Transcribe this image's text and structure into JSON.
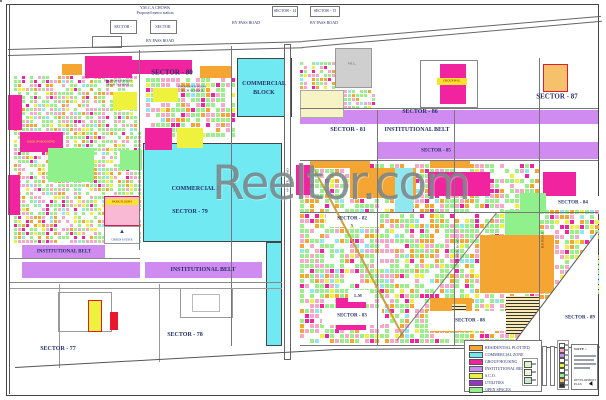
{
  "watermark": {
    "text": "Reeltor.com"
  },
  "map": {
    "mosaic_palette": {
      "cuts": [
        0.3,
        0.48,
        0.58,
        0.64,
        0.7,
        0.74
      ],
      "colors": [
        "#9BEE8C",
        "#F7A8C9",
        "#F5A531",
        "#F2239E",
        "#EEF23D",
        "#8FE8F0"
      ]
    },
    "mosaics": [
      {
        "x": 14,
        "y": 76,
        "w": 124,
        "h": 54,
        "cell": 4,
        "seed": 7
      },
      {
        "x": 14,
        "y": 132,
        "w": 126,
        "h": 112,
        "cell": 4,
        "seed": 13
      },
      {
        "x": 146,
        "y": 78,
        "w": 86,
        "h": 60,
        "cell": 5,
        "seed": 21
      },
      {
        "x": 300,
        "y": 164,
        "w": 238,
        "h": 178,
        "cell": 5,
        "seed": 29
      },
      {
        "x": 300,
        "y": 62,
        "w": 34,
        "h": 56,
        "cell": 4,
        "seed": 41
      },
      {
        "x": 336,
        "y": 90,
        "w": 40,
        "h": 28,
        "cell": 4,
        "seed": 55
      },
      {
        "x": 540,
        "y": 210,
        "w": 58,
        "h": 90,
        "cell": 5,
        "seed": 77
      }
    ],
    "areas": [
      {
        "x": 237,
        "y": 58,
        "w": 55,
        "h": 59,
        "c": "#70E9F2",
        "bd": "#444"
      },
      {
        "x": 143,
        "y": 143,
        "w": 139,
        "h": 99,
        "c": "#70E9F2",
        "bd": "#444"
      },
      {
        "x": 266,
        "y": 242,
        "w": 16,
        "h": 104,
        "c": "#70E9F2",
        "bd": "#444"
      },
      {
        "x": 300,
        "y": 110,
        "w": 298,
        "h": 14,
        "c": "#CF8BEF"
      },
      {
        "x": 378,
        "y": 142,
        "w": 220,
        "h": 17,
        "c": "#CF8BEF"
      },
      {
        "x": 22,
        "y": 245,
        "w": 83,
        "h": 13,
        "c": "#CF8BEF"
      },
      {
        "x": 22,
        "y": 262,
        "w": 118,
        "h": 16,
        "c": "#CF8BEF"
      },
      {
        "x": 145,
        "y": 262,
        "w": 117,
        "h": 16,
        "c": "#CF8BEF"
      },
      {
        "x": 85,
        "y": 56,
        "w": 47,
        "h": 22,
        "c": "#F2239E"
      },
      {
        "x": 132,
        "y": 60,
        "w": 60,
        "h": 14,
        "c": "#F2239E"
      },
      {
        "x": 200,
        "y": 66,
        "w": 32,
        "h": 12,
        "c": "#F5A531"
      },
      {
        "x": 62,
        "y": 64,
        "w": 20,
        "h": 11,
        "c": "#F5A531"
      },
      {
        "x": 113,
        "y": 92,
        "w": 24,
        "h": 18,
        "c": "#EEF23D"
      },
      {
        "x": 153,
        "y": 88,
        "w": 25,
        "h": 14,
        "c": "#EEF23D"
      },
      {
        "x": 145,
        "y": 128,
        "w": 27,
        "h": 22,
        "c": "#F2239E"
      },
      {
        "x": 177,
        "y": 128,
        "w": 26,
        "h": 20,
        "c": "#EEF23D"
      },
      {
        "x": 8,
        "y": 95,
        "w": 14,
        "h": 35,
        "c": "#F2239E"
      },
      {
        "x": 20,
        "y": 132,
        "w": 43,
        "h": 20,
        "c": "#F2239E"
      },
      {
        "x": 8,
        "y": 175,
        "w": 12,
        "h": 40,
        "c": "#F2239E"
      },
      {
        "x": 48,
        "y": 148,
        "w": 46,
        "h": 34,
        "c": "#90F08B"
      },
      {
        "x": 120,
        "y": 150,
        "w": 22,
        "h": 20,
        "c": "#90F08B"
      },
      {
        "x": 335,
        "y": 48,
        "w": 37,
        "h": 40,
        "c": "#CFCFCF",
        "bd": "#999"
      },
      {
        "x": 300,
        "y": 90,
        "w": 44,
        "h": 28,
        "c": "#F7F3C4",
        "bd": "#aaa"
      },
      {
        "x": 543,
        "y": 64,
        "w": 25,
        "h": 28,
        "c": "#F5C26B",
        "bd": "#E8192C"
      },
      {
        "x": 350,
        "y": 168,
        "w": 66,
        "h": 30,
        "c": "#F5A531"
      },
      {
        "x": 428,
        "y": 172,
        "w": 62,
        "h": 24,
        "c": "#F2239E"
      },
      {
        "x": 543,
        "y": 172,
        "w": 33,
        "h": 24,
        "c": "#F2239E"
      },
      {
        "x": 395,
        "y": 168,
        "w": 18,
        "h": 44,
        "c": "#8FE8F0"
      },
      {
        "x": 296,
        "y": 165,
        "w": 14,
        "h": 30,
        "c": "#F2239E"
      },
      {
        "x": 505,
        "y": 210,
        "w": 34,
        "h": 36,
        "c": "#90F08B"
      },
      {
        "x": 520,
        "y": 193,
        "w": 26,
        "h": 20,
        "c": "#90F08B"
      },
      {
        "x": 480,
        "y": 235,
        "w": 74,
        "h": 58,
        "c": "#F5A531"
      },
      {
        "x": 430,
        "y": 298,
        "w": 42,
        "h": 34,
        "c": "#F5A531"
      },
      {
        "x": 556,
        "y": 286,
        "w": 32,
        "h": 34,
        "c": "#F2239E"
      },
      {
        "x": 336,
        "y": 298,
        "w": 30,
        "h": 32,
        "c": "#F2239E"
      },
      {
        "x": 506,
        "y": 296,
        "w": 34,
        "h": 38,
        "stripe": true
      },
      {
        "x": 452,
        "y": 304,
        "w": 14,
        "h": 18,
        "stripe": true
      },
      {
        "x": 310,
        "y": 160,
        "w": 60,
        "h": 8,
        "c": "#F5A531"
      },
      {
        "x": 430,
        "y": 160,
        "w": 40,
        "h": 8,
        "c": "#F5A531"
      },
      {
        "x": 512,
        "y": 230,
        "w": 86,
        "h": 115,
        "c": "#fff",
        "clip": "polygon(100% 0, 100% 100%, 0 100%)"
      },
      {
        "x": 326,
        "y": 212,
        "w": 54,
        "h": 15,
        "c": "#fff"
      },
      {
        "x": 548,
        "y": 196,
        "w": 52,
        "h": 14,
        "c": "#fff"
      },
      {
        "x": 348,
        "y": 290,
        "w": 22,
        "h": 12,
        "c": "#fff"
      },
      {
        "x": 322,
        "y": 308,
        "w": 60,
        "h": 17,
        "c": "#fff"
      },
      {
        "x": 428,
        "y": 311,
        "w": 78,
        "h": 20,
        "c": "#fff"
      },
      {
        "x": 110,
        "y": 20,
        "w": 27,
        "h": 14,
        "c": "#fff",
        "bd": "#777"
      },
      {
        "x": 150,
        "y": 20,
        "w": 27,
        "h": 14,
        "c": "#fff",
        "bd": "#777"
      },
      {
        "x": 92,
        "y": 36,
        "w": 30,
        "h": 12,
        "c": "#fff",
        "bd": "#777"
      },
      {
        "x": 272,
        "y": 6,
        "w": 26,
        "h": 11,
        "c": "#fff",
        "bd": "#777"
      },
      {
        "x": 310,
        "y": 6,
        "w": 30,
        "h": 11,
        "c": "#fff",
        "bd": "#777"
      },
      {
        "x": 420,
        "y": 60,
        "w": 58,
        "h": 48,
        "c": "#fff",
        "bd": "#888"
      },
      {
        "x": 440,
        "y": 64,
        "w": 26,
        "h": 40,
        "c": "#F2239E"
      },
      {
        "x": 437,
        "y": 78,
        "w": 30,
        "h": 7,
        "c": "#F7E32B"
      },
      {
        "x": 58,
        "y": 292,
        "w": 54,
        "h": 40,
        "c": "#fff",
        "bd": "#999"
      },
      {
        "x": 180,
        "y": 288,
        "w": 53,
        "h": 30,
        "c": "#fff",
        "bd": "#999"
      },
      {
        "x": 192,
        "y": 294,
        "w": 28,
        "h": 18,
        "c": "#fff",
        "bd": "#bbb"
      },
      {
        "x": 88,
        "y": 300,
        "w": 14,
        "h": 32,
        "c": "#EEF23D",
        "bd": "#E8192C"
      },
      {
        "x": 110,
        "y": 312,
        "w": 8,
        "h": 18,
        "c": "#E8192C"
      },
      {
        "x": 104,
        "y": 196,
        "w": 36,
        "h": 30,
        "c": "#F9B8D4",
        "bd": "#cc2255"
      },
      {
        "x": 106,
        "y": 199,
        "w": 32,
        "h": 6,
        "c": "#F7E32B"
      },
      {
        "x": 104,
        "y": 226,
        "w": 36,
        "h": 18,
        "c": "#fff",
        "bd": "#999"
      },
      {
        "x": 284,
        "y": 44,
        "w": 7,
        "h": 316,
        "c": "#fff",
        "bd": "#666"
      }
    ],
    "roads": [
      {
        "x": 8,
        "y": 49,
        "l": 294,
        "a": -1.5
      },
      {
        "x": 302,
        "y": 41,
        "l": 300,
        "a": -4.8
      },
      {
        "x": 8,
        "y": 55,
        "l": 295,
        "a": -1.5
      },
      {
        "x": 302,
        "y": 47,
        "l": 301,
        "a": -5.0
      },
      {
        "x": 10,
        "y": 4,
        "l": 390,
        "a": 90,
        "c": "#555"
      },
      {
        "x": 140,
        "y": 50,
        "l": 200,
        "a": 90,
        "c": "#777"
      },
      {
        "x": 232,
        "y": 46,
        "l": 300,
        "a": 90,
        "c": "#777"
      },
      {
        "x": 378,
        "y": 110,
        "l": 236,
        "a": 90,
        "c": "#777"
      },
      {
        "x": 455,
        "y": 110,
        "l": 236,
        "a": 90,
        "c": "#777"
      },
      {
        "x": 540,
        "y": 58,
        "l": 288,
        "a": 90,
        "c": "#777"
      },
      {
        "x": 300,
        "y": 108,
        "l": 298,
        "a": 0,
        "c": "#777"
      },
      {
        "x": 300,
        "y": 160,
        "l": 298,
        "a": 0,
        "c": "#777"
      },
      {
        "x": 300,
        "y": 212,
        "l": 298,
        "a": 0,
        "c": "#777"
      },
      {
        "x": 300,
        "y": 345,
        "l": 215,
        "a": 0,
        "c": "#777"
      },
      {
        "x": 10,
        "y": 258,
        "l": 130,
        "a": 0,
        "c": "#888"
      },
      {
        "x": 10,
        "y": 282,
        "l": 272,
        "a": 0,
        "c": "#888"
      },
      {
        "x": 10,
        "y": 288,
        "l": 272,
        "a": 0,
        "c": "#999"
      },
      {
        "x": 60,
        "y": 284,
        "l": 84,
        "a": 90,
        "c": "#999"
      },
      {
        "x": 160,
        "y": 284,
        "l": 78,
        "a": 90,
        "c": "#999"
      },
      {
        "x": 15,
        "y": 367,
        "l": 320,
        "a": -3.2,
        "c": "#555"
      },
      {
        "x": 334,
        "y": 349,
        "l": 266,
        "a": -0.5,
        "c": "#555"
      },
      {
        "x": 312,
        "y": 163,
        "l": 196,
        "a": 62,
        "t": 2,
        "c": "#C9A23F"
      },
      {
        "x": 497,
        "y": 213,
        "l": 162,
        "a": 128,
        "c": "#777"
      },
      {
        "x": 598,
        "y": 232,
        "l": 142,
        "a": 127,
        "c": "#555"
      }
    ],
    "labels": [
      {
        "t": "Y.M.C.A CHOWK",
        "x": 155,
        "y": 8,
        "s": 4
      },
      {
        "t": "Proposed metro station",
        "x": 155,
        "y": 13,
        "s": 4
      },
      {
        "t": "SECTOR -",
        "x": 123,
        "y": 27,
        "s": 4
      },
      {
        "t": "SECTOR",
        "x": 163,
        "y": 27,
        "s": 4
      },
      {
        "t": "BY PASS ROAD",
        "x": 246,
        "y": 23,
        "s": 4
      },
      {
        "t": "BY PASS ROAD",
        "x": 160,
        "y": 41,
        "s": 4
      },
      {
        "t": "SECTOR - 14",
        "x": 285,
        "y": 11,
        "s": 4
      },
      {
        "t": "SECTOR - 15",
        "x": 325,
        "y": 11,
        "s": 4
      },
      {
        "t": "BY PASS ROAD",
        "x": 324,
        "y": 23,
        "s": 4
      },
      {
        "t": "SECTOR - 80",
        "x": 172,
        "y": 73,
        "s": 7,
        "b": 1
      },
      {
        "t": "PROPOSED HIGH",
        "x": 118,
        "y": 81,
        "s": 3.5
      },
      {
        "t": "TECH SCHOOL",
        "x": 118,
        "y": 85,
        "s": 3.5
      },
      {
        "t": "PROPOSED HIGH",
        "x": 192,
        "y": 87,
        "s": 3.5
      },
      {
        "t": "TECH SCHOOL",
        "x": 192,
        "y": 91,
        "s": 3.5
      },
      {
        "t": "COMMERCIAL",
        "x": 264,
        "y": 84,
        "s": 6,
        "b": 1
      },
      {
        "t": "BLOCK",
        "x": 264,
        "y": 93,
        "s": 6,
        "b": 1
      },
      {
        "t": "VILL.",
        "x": 352,
        "y": 64,
        "s": 3.5,
        "c": "#555"
      },
      {
        "t": "SECTOR - 87",
        "x": 557,
        "y": 97,
        "s": 7,
        "b": 1
      },
      {
        "t": "SECTOR - 86",
        "x": 420,
        "y": 112,
        "s": 6,
        "b": 1
      },
      {
        "t": "SECTOR - 81",
        "x": 348,
        "y": 130,
        "s": 6,
        "b": 1
      },
      {
        "t": "INSTITUTIONAL BELT",
        "x": 417,
        "y": 130,
        "s": 6,
        "b": 1
      },
      {
        "t": "SECTOR - 85",
        "x": 436,
        "y": 151,
        "s": 5,
        "b": 1
      },
      {
        "t": "COMMERCIAL Z",
        "x": 196,
        "y": 189,
        "s": 6,
        "b": 1
      },
      {
        "t": "SECTOR - 79",
        "x": 190,
        "y": 212,
        "s": 6,
        "b": 1
      },
      {
        "t": "SECTOR - 84",
        "x": 573,
        "y": 203,
        "s": 5,
        "b": 1
      },
      {
        "t": "SECTOR - 82",
        "x": 352,
        "y": 219,
        "s": 5,
        "b": 1
      },
      {
        "t": "N",
        "x": 352,
        "y": 226,
        "s": 4
      },
      {
        "t": "INSTITUTIONAL BELT",
        "x": 64,
        "y": 252,
        "s": 5,
        "b": 1
      },
      {
        "t": "INSTITUTIONAL BELT",
        "x": 203,
        "y": 270,
        "s": 6,
        "b": 1
      },
      {
        "t": "L.M",
        "x": 358,
        "y": 296,
        "s": 4,
        "b": 1
      },
      {
        "t": "SECTOR - 83",
        "x": 352,
        "y": 316,
        "s": 5,
        "b": 1
      },
      {
        "t": "SECTOR - 88",
        "x": 470,
        "y": 321,
        "s": 5,
        "b": 1
      },
      {
        "t": "SECTOR - 89",
        "x": 580,
        "y": 318,
        "s": 5,
        "b": 1
      },
      {
        "t": "SECTOR - 78",
        "x": 185,
        "y": 335,
        "s": 6,
        "b": 1
      },
      {
        "t": "SECTOR - 77",
        "x": 58,
        "y": 349,
        "s": 6,
        "b": 1
      },
      {
        "t": "GROUP HOUSING",
        "x": 41,
        "y": 142,
        "s": 3.5,
        "c": "#FFE92B"
      },
      {
        "t": "PARK FLOORS",
        "x": 122,
        "y": 202,
        "s": 3,
        "c": "#a00000"
      },
      {
        "t": "GROUP HSG.",
        "x": 452,
        "y": 81,
        "s": 3,
        "c": "#a00000"
      },
      {
        "t": "▲",
        "x": 122,
        "y": 232,
        "s": 6,
        "c": "#1a3faa"
      },
      {
        "t": "GREEN ESTATE",
        "x": 122,
        "y": 240,
        "s": 3,
        "c": "#1a3faa"
      },
      {
        "t": "60 MTR. ROAD",
        "x": 288,
        "y": 180,
        "s": 3.5,
        "r": -90,
        "c": "#333"
      },
      {
        "t": "75 MTR. ROAD",
        "x": 458,
        "y": 250,
        "s": 3.5,
        "r": -90,
        "c": "#333"
      },
      {
        "t": "B.P. ROAD",
        "x": 543,
        "y": 240,
        "s": 3.5,
        "r": -90,
        "c": "#333"
      },
      {
        "t": "24 MTR. ROAD",
        "x": 235,
        "y": 180,
        "s": 3.5,
        "r": -90,
        "c": "#333"
      }
    ]
  },
  "legend": {
    "entries": [
      {
        "c": "#F5A531",
        "t": "RESIDENTIAL PLOTTED"
      },
      {
        "c": "#70E9F2",
        "t": "COMMERCIAL ZONE"
      },
      {
        "c": "#F2239E",
        "t": "GROUP HOUSING"
      },
      {
        "c": "#CF8BEF",
        "t": "INSTITUTIONAL BELT"
      },
      {
        "c": "#EEF23D",
        "t": "S.C.O."
      },
      {
        "c": "#9933CC",
        "t": "UTILITIES"
      },
      {
        "c": "#90F08B",
        "t": "OPEN SPACES"
      }
    ],
    "right_rows": [
      "#ffffff",
      "#F7A8C9",
      "#CF8BEF",
      "#ffffff",
      "#EEF23D",
      "#ffffff",
      "#90F08B",
      "#F5C26B",
      "#333333"
    ],
    "mini_rows": [
      "#D8F5C8",
      "#EFF8D8",
      "#C8EBD0"
    ],
    "scale_label": "Scale"
  },
  "notes": {
    "title": "NOTE :-",
    "footer": "DEVELOPMENT PLAN"
  }
}
